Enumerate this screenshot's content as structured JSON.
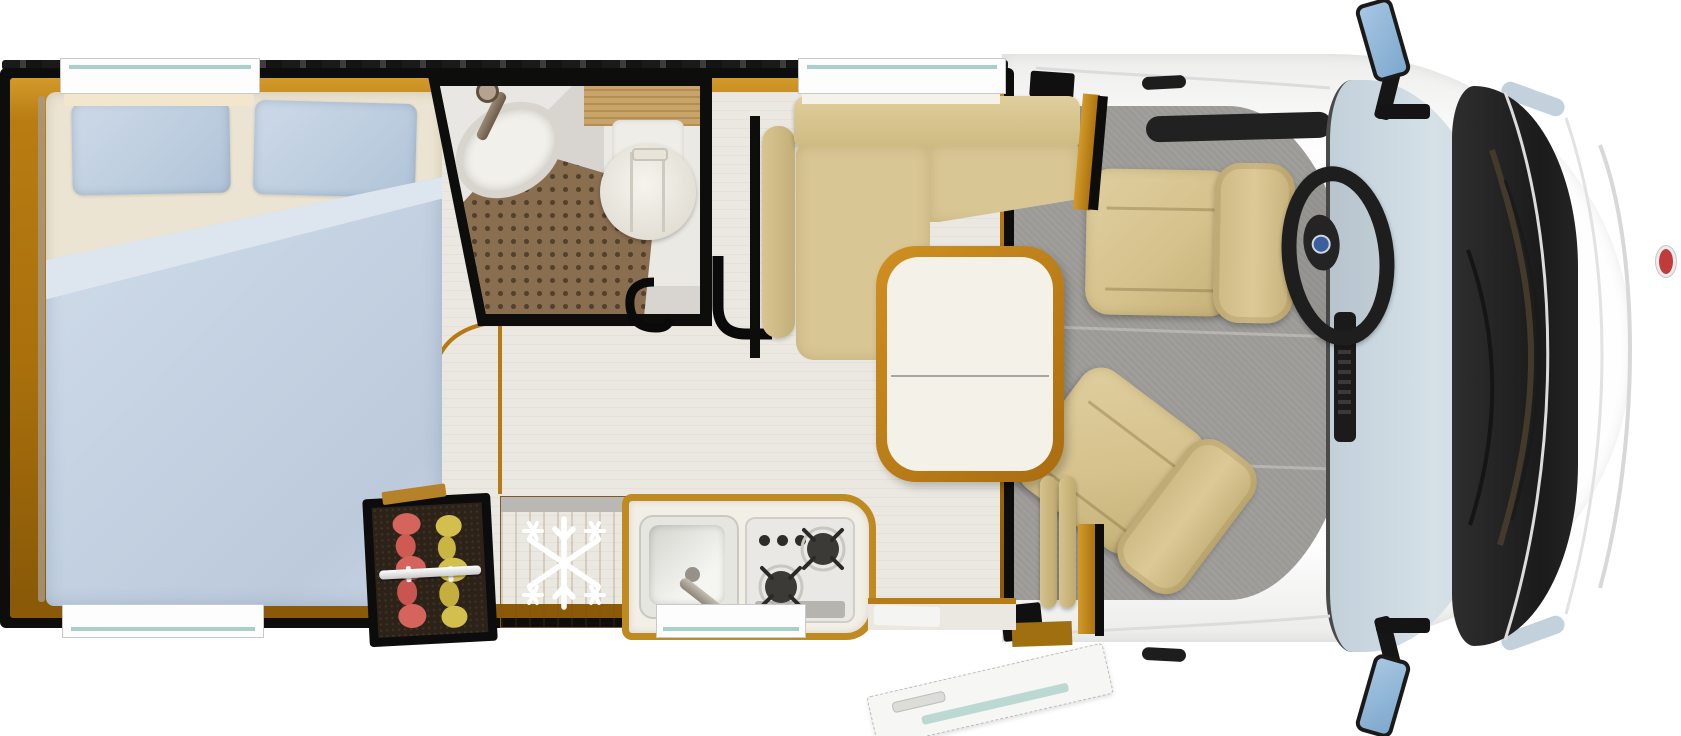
{
  "meta": {
    "description": "Top-down 3D floor plan rendering of a motorhome interior, cab at right, rear bedroom at left",
    "visible_text": "none"
  },
  "colors": {
    "bg": "#ffffff",
    "wall-black": "#0d0d0c",
    "wood-amber": "#c3830f",
    "wood-amber-dark": "#8a5a08",
    "wood-light": "#c89b5d",
    "floor-cream": "#ebe8e1",
    "floor-cab-grey": "#9b9a96",
    "duvet-blue": "#c5d3e3",
    "pillow-blue": "#bfcfe0",
    "mattress-cream": "#ece4d2",
    "sofa-beige": "#d5c28d",
    "seat-beige": "#d8c694",
    "table-top": "#f4f1e8",
    "bath-floor": "#d8d5d0",
    "shower-brown": "#8a6e50",
    "porcelain": "#efede8",
    "windshield-blue": "#ccd9e2",
    "body-white": "#fbfbfa",
    "cowl-black": "#242424",
    "mirror-blue": "#8fb6d6",
    "clothes-red": "#d4645c",
    "clothes-yellow": "#d2bf4e",
    "badge-blue": "#3a5f9e",
    "badge-red": "#c23b3b",
    "window-teal": "#a8cfc9",
    "stove-dark": "#3c3a37",
    "steel-grey": "#b9b8b4"
  },
  "areas": {
    "bedroom": {
      "fixtures": [
        "double-bed",
        "duvet",
        "pillow-left",
        "pillow-right",
        "window-top",
        "window-bottom"
      ]
    },
    "bathroom": {
      "fixtures": [
        "corner-sink",
        "faucet",
        "shower-floor",
        "toilet",
        "shelf",
        "door-swing-symbol"
      ]
    },
    "storage": {
      "fixtures": [
        "wardrobe-with-clothes",
        "hanging-rail",
        "fridge-with-snowflake"
      ]
    },
    "kitchen": {
      "fixtures": [
        "sink",
        "faucet",
        "two-burner-stove",
        "control-knobs",
        "window-bottom"
      ]
    },
    "dinette": {
      "fixtures": [
        "l-shaped-sofa",
        "armrest",
        "pedestal-table",
        "window-top"
      ]
    },
    "entry": {
      "fixtures": [
        "open-entry-door",
        "step",
        "partition",
        "pillar-cushions"
      ]
    },
    "cab": {
      "fixtures": [
        "driver-seat",
        "passenger-seat-swiveled",
        "steering-wheel",
        "dashboard",
        "center-console",
        "windshield",
        "wiper-cowl",
        "side-mirror-left",
        "side-mirror-right",
        "door-handles",
        "front-badge"
      ]
    }
  }
}
